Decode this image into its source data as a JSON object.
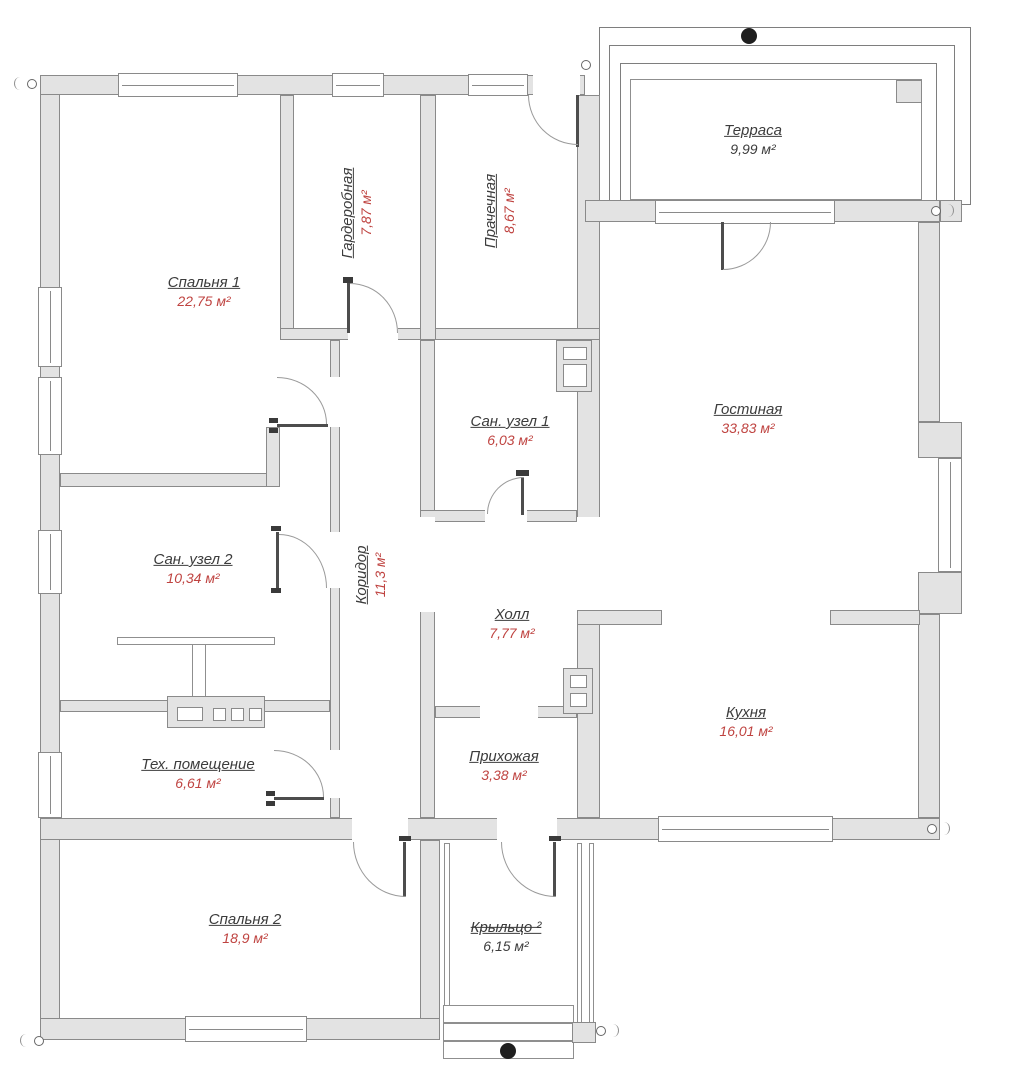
{
  "rooms": [
    {
      "name": "Терраса",
      "area": "9,99 м²"
    },
    {
      "name": "Спальня 1",
      "area": "22,75 м²"
    },
    {
      "name": "Гардеробная",
      "area": "7,87 м²"
    },
    {
      "name": "Прачечная",
      "area": "8,67 м²"
    },
    {
      "name": "Гостиная",
      "area": "33,83 м²"
    },
    {
      "name": "Сан. узел 1",
      "area": "6,03 м²"
    },
    {
      "name": "Сан. узел 2",
      "area": "10,34 м²"
    },
    {
      "name": "Коридор",
      "area": "11,3 м²"
    },
    {
      "name": "Холл",
      "area": "7,77 м²"
    },
    {
      "name": "Кухня",
      "area": "16,01 м²"
    },
    {
      "name": "Тех. помещение",
      "area": "6,61 м²"
    },
    {
      "name": "Прихожая",
      "area": "3,38 м²"
    },
    {
      "name": "Спальня 2",
      "area": "18,9 м²"
    },
    {
      "name": "Крыльцо ²",
      "area": "6,15 м²"
    }
  ],
  "colors": {
    "wall_fill": "#e3e3e3",
    "wall_line": "#8a8a8a",
    "room_name_color": "#3c3c3c",
    "area_value_color": "#bf4340"
  }
}
